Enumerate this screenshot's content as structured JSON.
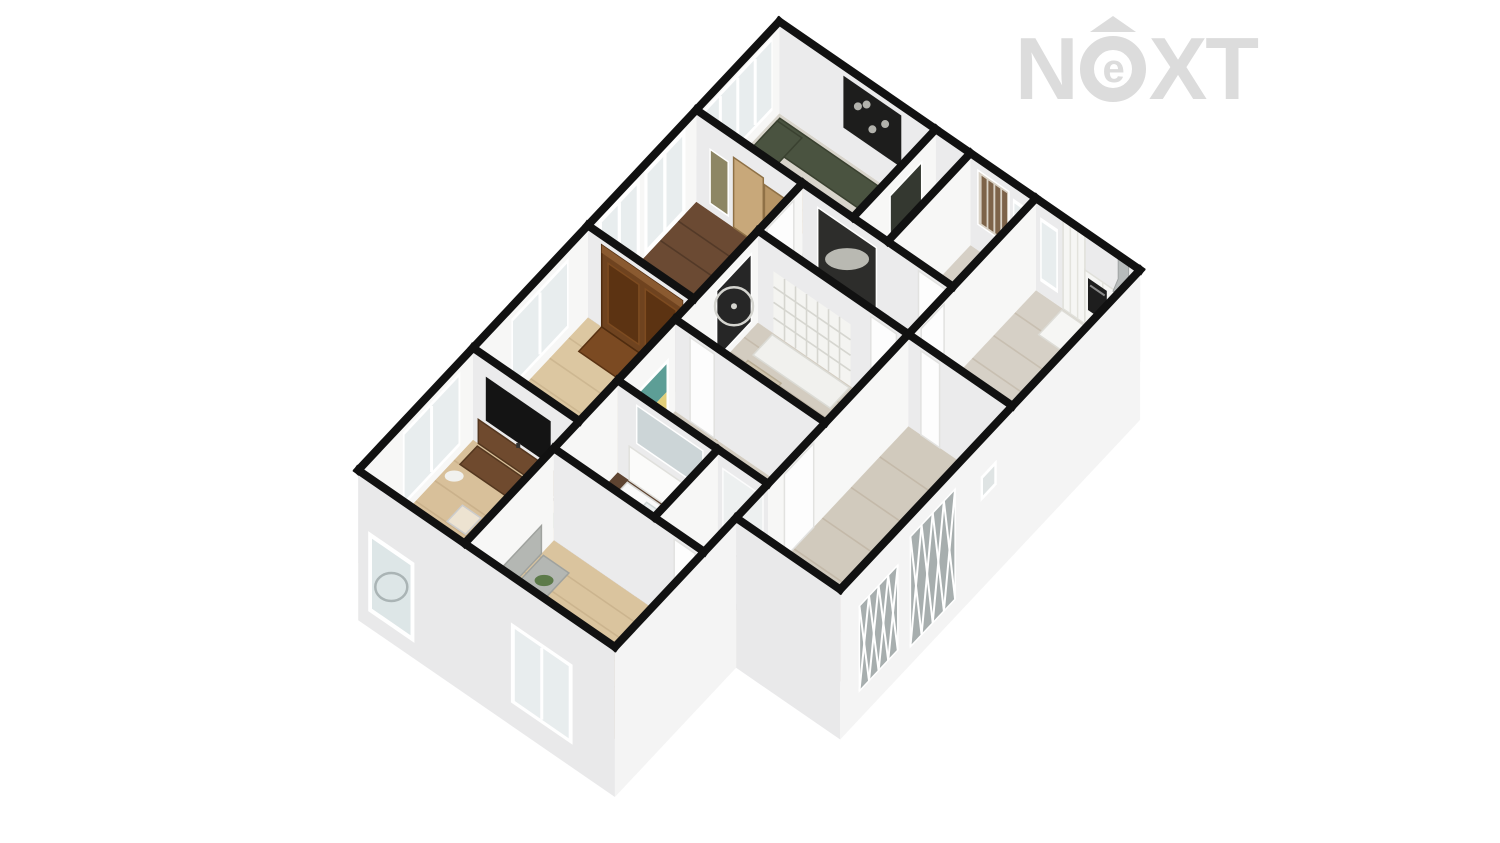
{
  "watermark": {
    "n": "N",
    "e": "e",
    "xt": "XT",
    "color": "#dcdcdc"
  },
  "floorplan": {
    "projection": {
      "ax": 0.771,
      "ay": 0.531,
      "bx": -0.638,
      "by": 0.68,
      "ox": 770,
      "oy": 107,
      "wallH": 92,
      "ground": 58
    },
    "palette": {
      "wallLine": "#111111",
      "faceBright": "#f7f7f6",
      "faceShade": "#ebebec",
      "skirtSE": "#f4f4f4",
      "skirtSW": "#e9e9ea",
      "glass": "#e8edee",
      "frame": "#ffffff"
    },
    "rooms": [
      {
        "name": "living-room",
        "x1": 12,
        "y1": 0,
        "x2": 215,
        "y2": 130,
        "floor": "#d8d4cb",
        "grain": null
      },
      {
        "name": "closet",
        "x1": 215,
        "y1": 0,
        "x2": 260,
        "y2": 130,
        "floor": "#d6d2c9",
        "grain": null
      },
      {
        "name": "dining-room",
        "x1": 260,
        "y1": 0,
        "x2": 345,
        "y2": 130,
        "floor": "#d6d0c6",
        "grain": null
      },
      {
        "name": "kitchen",
        "x1": 345,
        "y1": 0,
        "x2": 480,
        "y2": 200,
        "floor": "#d6d0c6",
        "grain": "x"
      },
      {
        "name": "bedroom-upper",
        "x1": 12,
        "y1": 130,
        "x2": 150,
        "y2": 300,
        "floor": "#6b4a33",
        "grain": "x"
      },
      {
        "name": "corridor",
        "x1": 150,
        "y1": 130,
        "x2": 345,
        "y2": 200,
        "floor": "#d3ccc0",
        "grain": null
      },
      {
        "name": "hallway",
        "x1": 150,
        "y1": 200,
        "x2": 345,
        "y2": 330,
        "floor": "#d3ccc0",
        "grain": "x"
      },
      {
        "name": "entry-hall",
        "x1": 345,
        "y1": 200,
        "x2": 480,
        "y2": 470,
        "floor": "#d1cabd",
        "grain": "x"
      },
      {
        "name": "bedroom-middle",
        "x1": 12,
        "y1": 300,
        "x2": 150,
        "y2": 480,
        "floor": "#dcc7a1",
        "grain": "x"
      },
      {
        "name": "inner-hall",
        "x1": 150,
        "y1": 330,
        "x2": 345,
        "y2": 420,
        "floor": "#d3ccc0",
        "grain": null
      },
      {
        "name": "bathroom",
        "x1": 150,
        "y1": 420,
        "x2": 280,
        "y2": 520,
        "floor": "#5e4431",
        "grain": "x"
      },
      {
        "name": "shower-room",
        "x1": 280,
        "y1": 420,
        "x2": 345,
        "y2": 520,
        "floor": "#5e4431",
        "grain": null
      },
      {
        "name": "tv-room",
        "x1": 12,
        "y1": 480,
        "x2": 150,
        "y2": 660,
        "floor": "#d8c09a",
        "grain": "x"
      },
      {
        "name": "bedroom-lower",
        "x1": 150,
        "y1": 520,
        "x2": 345,
        "y2": 660,
        "floor": "#dac49e",
        "grain": "x"
      }
    ],
    "furniture": [
      {
        "name": "sofa-back",
        "kind": "rect",
        "x1": 16,
        "y1": 4,
        "x2": 180,
        "y2": 36,
        "fill": "#4a5340",
        "stroke": "#3a4130"
      },
      {
        "name": "sofa-side",
        "kind": "rect",
        "x1": 16,
        "y1": 8,
        "x2": 48,
        "y2": 125,
        "fill": "#4a5340",
        "stroke": "#3a4130"
      },
      {
        "name": "sofa-chaise",
        "kind": "rect",
        "x1": 148,
        "y1": 36,
        "x2": 180,
        "y2": 78,
        "fill": "#4f5844",
        "stroke": "#3a4130"
      },
      {
        "name": "sofa-ottoman",
        "kind": "rect",
        "x1": 135,
        "y1": 92,
        "x2": 175,
        "y2": 128,
        "fill": "#49523e",
        "stroke": "#3a4130"
      },
      {
        "name": "coffee-table",
        "kind": "rect",
        "x1": 78,
        "y1": 52,
        "x2": 128,
        "y2": 92,
        "fill": "#c78a40",
        "stroke": "#a96f2c",
        "lines": 3
      },
      {
        "name": "kitchen-counter",
        "kind": "rect",
        "x1": 380,
        "y1": 2,
        "x2": 478,
        "y2": 38,
        "fill": "#f6f6f4",
        "stroke": "#dddcd6"
      },
      {
        "name": "cooktop",
        "kind": "rect",
        "x1": 448,
        "y1": 6,
        "x2": 474,
        "y2": 32,
        "fill": "#2a2a2a",
        "stroke": "#1c1c1c"
      },
      {
        "name": "desk",
        "kind": "rect",
        "x1": 275,
        "y1": 80,
        "x2": 340,
        "y2": 118,
        "fill": "#5f3822",
        "stroke": "#4a2a18"
      },
      {
        "name": "desk-chair",
        "kind": "rect",
        "x1": 298,
        "y1": 56,
        "x2": 317,
        "y2": 74,
        "fill": "#4a3322",
        "stroke": "#38250f"
      },
      {
        "name": "bookshelf-top",
        "kind": "rect",
        "x1": 170,
        "y1": 202,
        "x2": 270,
        "y2": 232,
        "fill": "#f1f1ee",
        "stroke": "#dbdbd5"
      },
      {
        "name": "lounge-chair",
        "kind": "rect",
        "x1": 170,
        "y1": 240,
        "x2": 213,
        "y2": 303,
        "fill": "#cfc4ae",
        "stroke": "#b8ac94"
      },
      {
        "name": "lounge-ottoman",
        "kind": "rect",
        "x1": 173,
        "y1": 306,
        "x2": 205,
        "y2": 330,
        "fill": "#cfc4ae",
        "stroke": "#b8ac94"
      },
      {
        "name": "armoire-top",
        "kind": "rect",
        "x1": 30,
        "y1": 300,
        "x2": 135,
        "y2": 336,
        "fill": "#7b4a22",
        "stroke": "#5a3212"
      },
      {
        "name": "bed",
        "kind": "rect",
        "x1": 20,
        "y1": 400,
        "x2": 120,
        "y2": 476,
        "fill": "#c8c7c3",
        "stroke": "#b5b4b0"
      },
      {
        "name": "bed-pillows",
        "kind": "rect",
        "x1": 24,
        "y1": 404,
        "x2": 116,
        "y2": 422,
        "fill": "#dddcd8",
        "stroke": "#cccbc7"
      },
      {
        "name": "vanity-counter",
        "kind": "rect",
        "x1": 165,
        "y1": 423,
        "x2": 270,
        "y2": 452,
        "fill": "#fafafa",
        "stroke": "#d9d9d6"
      },
      {
        "name": "vanity-basin",
        "kind": "rect",
        "x1": 195,
        "y1": 429,
        "x2": 240,
        "y2": 447,
        "fill": "#e9edee",
        "stroke": "#cfd6d6"
      },
      {
        "name": "shower-tray",
        "kind": "rect",
        "x1": 288,
        "y1": 424,
        "x2": 340,
        "y2": 468,
        "fill": "#e9ecec",
        "stroke": "#d2d8d8"
      },
      {
        "name": "tv-console",
        "kind": "rect",
        "x1": 20,
        "y1": 483,
        "x2": 120,
        "y2": 510,
        "fill": "#6f4a2e",
        "stroke": "#54371f"
      },
      {
        "name": "plant-tv-room",
        "kind": "ellipse",
        "cx": 132,
        "cy": 505,
        "r": 13,
        "fill": "#57754a"
      },
      {
        "name": "floor-lamp",
        "kind": "ellipse",
        "cx": 24,
        "cy": 524,
        "r": 9,
        "fill": "#f1f1ee"
      },
      {
        "name": "glass-table-1",
        "kind": "rect",
        "x1": 52,
        "y1": 545,
        "x2": 76,
        "y2": 569,
        "fill": "rgba(255,255,255,0.55)",
        "stroke": "#cccccc"
      },
      {
        "name": "glass-table-2",
        "kind": "rect",
        "x1": 70,
        "y1": 576,
        "x2": 94,
        "y2": 600,
        "fill": "rgba(255,255,255,0.55)",
        "stroke": "#cccccc"
      },
      {
        "name": "wood-chest",
        "kind": "rect",
        "x1": 100,
        "y1": 624,
        "x2": 136,
        "y2": 652,
        "fill": "#5a3a24",
        "stroke": "#452a16"
      },
      {
        "name": "dresser-top",
        "kind": "rect",
        "x1": 153,
        "y1": 540,
        "x2": 186,
        "y2": 645,
        "fill": "#b4b7b3",
        "stroke": "#9fa29e"
      },
      {
        "name": "plant-dresser",
        "kind": "ellipse",
        "cx": 172,
        "cy": 562,
        "r": 9,
        "fill": "#5c7a49"
      },
      {
        "name": "stairs",
        "kind": "steps",
        "x1": 288,
        "y1": 520,
        "x2": 342,
        "y2": 586,
        "n": 6
      }
    ],
    "walls": [
      {
        "name": "living-nw",
        "x1": 12,
        "y1": 0,
        "x2": 12,
        "y2": 130,
        "face": "bright",
        "items": [
          {
            "kind": "window",
            "t0": 0.08,
            "t1": 0.92,
            "h0": 10,
            "h1": 84,
            "panes": 4
          }
        ]
      },
      {
        "name": "living-ne",
        "x1": 12,
        "y1": 0,
        "x2": 215,
        "y2": 0,
        "face": "shade",
        "items": [
          {
            "kind": "art-dark",
            "t0": 0.41,
            "t1": 0.78,
            "h0": 30,
            "h1": 82
          }
        ]
      },
      {
        "name": "closet-nw",
        "x1": 215,
        "y1": 0,
        "x2": 215,
        "y2": 130,
        "face": "bright",
        "items": [
          {
            "kind": "art",
            "t0": 0.17,
            "t1": 0.55,
            "h0": 26,
            "h1": 74,
            "color": "#343830"
          }
        ]
      },
      {
        "name": "dining-nw",
        "x1": 260,
        "y1": 0,
        "x2": 260,
        "y2": 130,
        "face": "bright",
        "items": []
      },
      {
        "name": "dining-ne",
        "x1": 215,
        "y1": 0,
        "x2": 345,
        "y2": 0,
        "face": "shade",
        "items": [
          {
            "kind": "art-stripe",
            "t0": 0.42,
            "t1": 0.73,
            "h0": 26,
            "h1": 80
          },
          {
            "kind": "window",
            "t0": 0.77,
            "t1": 0.96,
            "h0": 12,
            "h1": 76,
            "panes": 1
          }
        ]
      },
      {
        "name": "kitchen-ne",
        "x1": 345,
        "y1": 0,
        "x2": 480,
        "y2": 0,
        "face": "shade",
        "items": [
          {
            "kind": "window",
            "t0": 0.04,
            "t1": 0.21,
            "h0": 12,
            "h1": 76,
            "panes": 1
          },
          {
            "kind": "cabinet",
            "t0": 0.26,
            "t1": 0.47,
            "h0": 0,
            "h1": 88
          },
          {
            "kind": "cabinet",
            "t0": 0.47,
            "t1": 0.985,
            "h0": 0,
            "h1": 54
          },
          {
            "kind": "oven",
            "t0": 0.5,
            "t1": 0.68,
            "h0": 16,
            "h1": 48
          },
          {
            "kind": "hood",
            "t0": 0.74,
            "t1": 0.94,
            "h0": 52,
            "h1": 88
          }
        ]
      },
      {
        "name": "kitchen-nw",
        "x1": 345,
        "y1": 0,
        "x2": 345,
        "y2": 200,
        "face": "bright",
        "items": [
          {
            "kind": "door",
            "t0": 0.72,
            "t1": 0.9,
            "h0": 0,
            "h1": 84
          }
        ]
      },
      {
        "name": "bedroomTL-nw",
        "x1": 12,
        "y1": 130,
        "x2": 12,
        "y2": 300,
        "face": "bright",
        "items": [
          {
            "kind": "french",
            "t0": 0.1,
            "t1": 0.48,
            "h0": 0,
            "h1": 86
          },
          {
            "kind": "french",
            "t0": 0.52,
            "t1": 0.9,
            "h0": 0,
            "h1": 86
          }
        ]
      },
      {
        "name": "bedroomTL-ne",
        "x1": 12,
        "y1": 130,
        "x2": 150,
        "y2": 130,
        "face": "shade",
        "items": [
          {
            "kind": "art",
            "t0": 0.13,
            "t1": 0.3,
            "h0": 8,
            "h1": 62,
            "color": "#8d8664"
          },
          {
            "kind": "panel",
            "t0": 0.35,
            "t1": 0.63,
            "h0": 0,
            "h1": 70,
            "color": "#c8a87a"
          },
          {
            "kind": "panel",
            "t0": 0.64,
            "t1": 0.92,
            "h0": 0,
            "h1": 64,
            "color": "#b79565"
          }
        ]
      },
      {
        "name": "corridor-nw",
        "x1": 150,
        "y1": 130,
        "x2": 150,
        "y2": 200,
        "face": "bright",
        "items": [
          {
            "kind": "door",
            "t0": 0.2,
            "t1": 0.8,
            "h0": 0,
            "h1": 84
          }
        ]
      },
      {
        "name": "corridor-ne",
        "x1": 150,
        "y1": 130,
        "x2": 345,
        "y2": 130,
        "face": "shade",
        "items": [
          {
            "kind": "art-horse",
            "t0": 0.1,
            "t1": 0.49,
            "h0": 15,
            "h1": 78
          },
          {
            "kind": "door",
            "t0": 0.77,
            "t1": 0.95,
            "h0": 0,
            "h1": 84
          }
        ]
      },
      {
        "name": "hallway-nw",
        "x1": 150,
        "y1": 200,
        "x2": 150,
        "y2": 330,
        "face": "bright",
        "items": [
          {
            "kind": "art-ferris",
            "t0": 0.08,
            "t1": 0.5,
            "h0": 8,
            "h1": 76
          }
        ]
      },
      {
        "name": "hallway-ne",
        "x1": 150,
        "y1": 200,
        "x2": 345,
        "y2": 200,
        "face": "shade",
        "items": [
          {
            "kind": "shelf",
            "t0": 0.103,
            "t1": 0.615,
            "h0": 0,
            "h1": 62
          },
          {
            "kind": "door",
            "t0": 0.75,
            "t1": 0.92,
            "h0": 0,
            "h1": 84
          }
        ]
      },
      {
        "name": "entry-nw",
        "x1": 345,
        "y1": 200,
        "x2": 345,
        "y2": 470,
        "face": "bright",
        "items": [
          {
            "kind": "door",
            "t0": 0.55,
            "t1": 0.72,
            "h0": 0,
            "h1": 84
          }
        ]
      },
      {
        "name": "entry-ne",
        "x1": 345,
        "y1": 200,
        "x2": 480,
        "y2": 200,
        "face": "shade",
        "items": [
          {
            "kind": "door",
            "t0": 0.12,
            "t1": 0.3,
            "h0": 0,
            "h1": 84
          }
        ]
      },
      {
        "name": "bedroomM-nw",
        "x1": 12,
        "y1": 300,
        "x2": 12,
        "y2": 480,
        "face": "bright",
        "items": [
          {
            "kind": "window",
            "t0": 0.167,
            "t1": 0.667,
            "h0": 10,
            "h1": 80,
            "panes": 2
          }
        ]
      },
      {
        "name": "bedroomM-ne",
        "x1": 12,
        "y1": 300,
        "x2": 150,
        "y2": 300,
        "face": "shade",
        "items": [
          {
            "kind": "armoire",
            "t0": 0.13,
            "t1": 0.89,
            "h0": 0,
            "h1": 82
          }
        ]
      },
      {
        "name": "innerhall-nw",
        "x1": 150,
        "y1": 330,
        "x2": 150,
        "y2": 420,
        "face": "bright",
        "items": [
          {
            "kind": "art-beach",
            "t0": 0.11,
            "t1": 0.78,
            "h0": 2,
            "h1": 60
          }
        ]
      },
      {
        "name": "innerhall-ne",
        "x1": 150,
        "y1": 330,
        "x2": 345,
        "y2": 330,
        "face": "shade",
        "items": [
          {
            "kind": "door",
            "t0": 0.1,
            "t1": 0.26,
            "h0": 0,
            "h1": 84
          }
        ]
      },
      {
        "name": "bathroom-nw",
        "x1": 150,
        "y1": 420,
        "x2": 150,
        "y2": 520,
        "face": "bright",
        "items": []
      },
      {
        "name": "bathroom-ne",
        "x1": 150,
        "y1": 420,
        "x2": 280,
        "y2": 420,
        "face": "shade",
        "items": [
          {
            "kind": "vanity",
            "t0": 0.115,
            "t1": 0.92,
            "h0": 0,
            "h1": 34
          },
          {
            "kind": "mirror",
            "t0": 0.19,
            "t1": 0.85,
            "h0": 42,
            "h1": 80
          }
        ]
      },
      {
        "name": "shower-nw",
        "x1": 280,
        "y1": 420,
        "x2": 280,
        "y2": 520,
        "face": "bright",
        "items": []
      },
      {
        "name": "shower-ne",
        "x1": 280,
        "y1": 420,
        "x2": 345,
        "y2": 420,
        "face": "shade",
        "items": [
          {
            "kind": "shower",
            "t0": 0.1,
            "t1": 0.9,
            "h0": 0,
            "h1": 76
          }
        ]
      },
      {
        "name": "tvroom-nw",
        "x1": 12,
        "y1": 480,
        "x2": 12,
        "y2": 660,
        "face": "bright",
        "items": [
          {
            "kind": "window",
            "t0": 0.111,
            "t1": 0.611,
            "h0": 8,
            "h1": 82,
            "panes": 2
          }
        ]
      },
      {
        "name": "tvroom-ne",
        "x1": 12,
        "y1": 480,
        "x2": 150,
        "y2": 480,
        "face": "shade",
        "items": [
          {
            "kind": "console",
            "t0": 0.05,
            "t1": 0.8,
            "h0": 0,
            "h1": 24
          },
          {
            "kind": "tv",
            "t0": 0.12,
            "t1": 0.73,
            "h0": 28,
            "h1": 72
          }
        ]
      },
      {
        "name": "bedroomL-nw",
        "x1": 150,
        "y1": 520,
        "x2": 150,
        "y2": 660,
        "face": "bright",
        "items": [
          {
            "kind": "dresser",
            "t0": 0.14,
            "t1": 0.89,
            "h0": 0,
            "h1": 28
          }
        ]
      },
      {
        "name": "bedroomL-ne",
        "x1": 150,
        "y1": 520,
        "x2": 345,
        "y2": 520,
        "face": "shade",
        "items": [
          {
            "kind": "door",
            "t0": 0.8,
            "t1": 0.94,
            "h0": 0,
            "h1": 84
          }
        ]
      }
    ],
    "skirts": [
      {
        "name": "exterior-se-main",
        "x1": 480,
        "y1": 0,
        "x2": 480,
        "y2": 470,
        "side": "SE",
        "items": [
          {
            "kind": "vent",
            "t0": 0.478,
            "t1": 0.532,
            "h0": 30,
            "h1": 55
          },
          {
            "kind": "lattice",
            "t0": 0.617,
            "t1": 0.766,
            "h0": -40,
            "h1": 70
          },
          {
            "kind": "lattice",
            "t0": 0.808,
            "t1": 0.936,
            "h0": -30,
            "h1": 55
          }
        ]
      },
      {
        "name": "exterior-sw-notch",
        "x1": 480,
        "y1": 470,
        "x2": 345,
        "y2": 470,
        "side": "SW",
        "items": []
      },
      {
        "name": "exterior-se-lower",
        "x1": 345,
        "y1": 470,
        "x2": 345,
        "y2": 660,
        "side": "SE",
        "items": []
      },
      {
        "name": "exterior-sw-main",
        "x1": 345,
        "y1": 660,
        "x2": 12,
        "y2": 660,
        "side": "SW",
        "items": [
          {
            "kind": "window2",
            "t0": 0.165,
            "t1": 0.405,
            "h0": -35,
            "h1": 45
          },
          {
            "kind": "picture",
            "t0": 0.781,
            "t1": 0.961,
            "h0": -42,
            "h1": 38
          }
        ]
      }
    ]
  }
}
